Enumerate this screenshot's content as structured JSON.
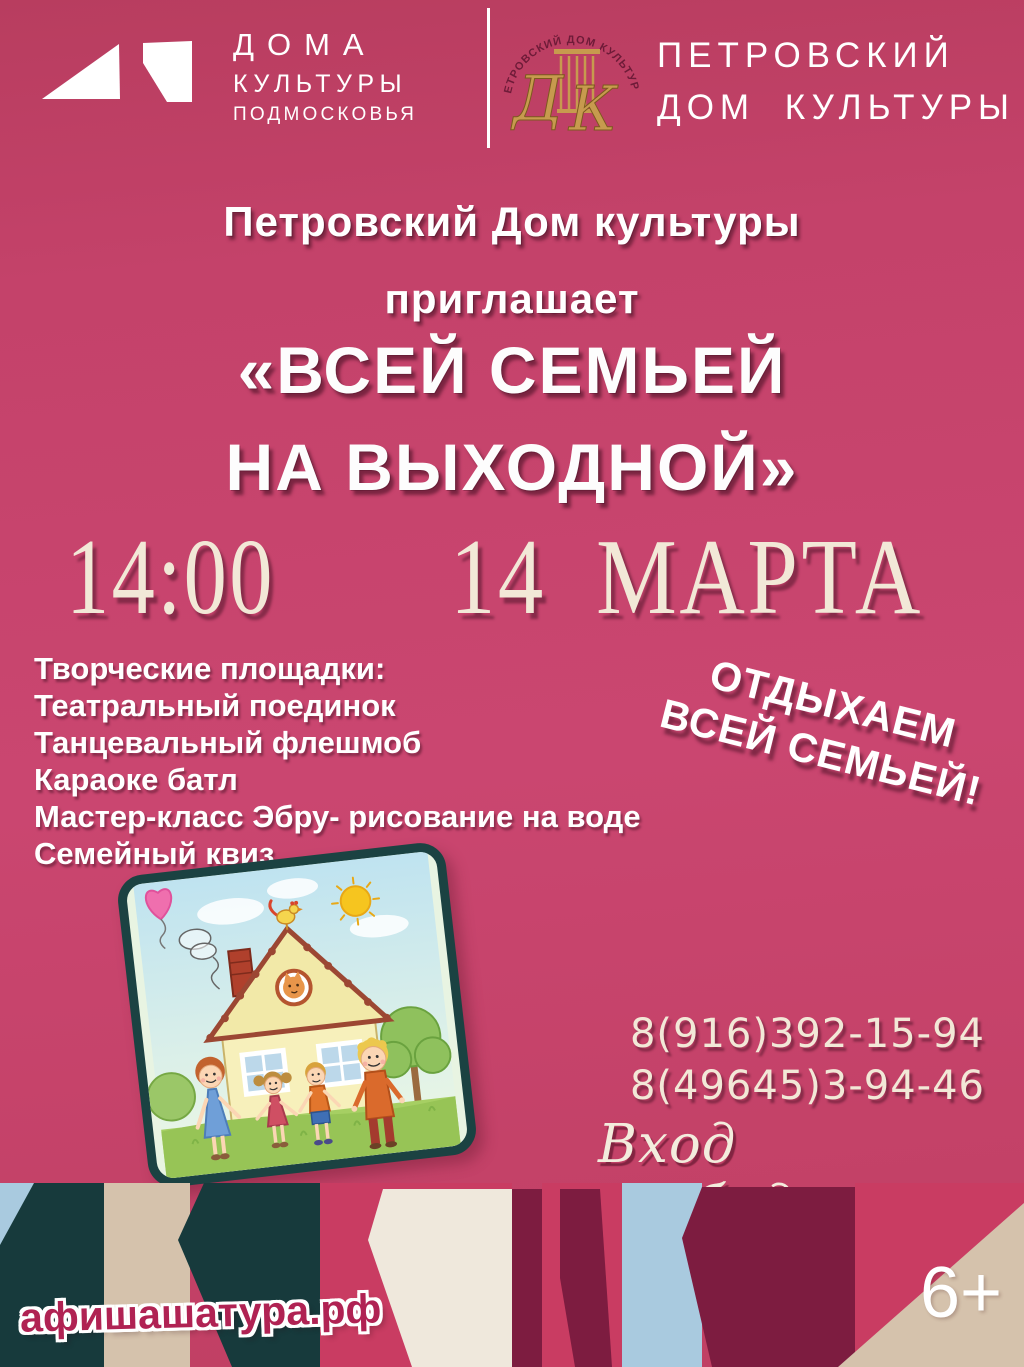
{
  "header": {
    "brand_left": {
      "line1": "ДОМА",
      "line2": "КУЛЬТУРЫ",
      "line3": "ПОДМОСКОВЬЯ"
    },
    "brand_right": {
      "line1": "ПЕТРОВСКИЙ",
      "line2": "ДОМ КУЛЬТУРЫ",
      "emblem_arc_text": "ПЕТРОВСКИЙ ДОМ КУЛЬТУРЫ",
      "monogram_d": "Д",
      "monogram_k": "К"
    }
  },
  "intro": {
    "line1": "Петровский Дом культуры",
    "line2": "приглашает"
  },
  "title": {
    "line1": "«ВСЕЙ СЕМЬЕЙ",
    "line2": "НА ВЫХОДНОЙ»"
  },
  "schedule": {
    "time": "14:00",
    "date": "14 МАРТА"
  },
  "activities": {
    "heading": "Творческие площадки:",
    "items": [
      "Театральный поединок",
      "Танцевальный флешмоб",
      "Караоке батл",
      "Мастер-класс Эбру- рисование на воде",
      "Семейный квиз"
    ]
  },
  "slogan": {
    "line1": "ОТДЫХАЕМ",
    "line2": "ВСЕЙ СЕМЬЕЙ!"
  },
  "contacts": {
    "phone1": "8(916)392-15-94",
    "phone2": "8(49645)3-94-46",
    "admission": "Вход свободный"
  },
  "footer": {
    "site": "афишашатура.рф",
    "age_rating": "6+"
  },
  "illustration": {
    "name": "cartoon-family-house"
  },
  "colors": {
    "background": "#c4426a",
    "text_cream": "#f2e8d7",
    "band_teal": "#173a3c",
    "band_blue": "#a9cadf",
    "band_beige": "#d5c2ac",
    "band_cream": "#efe8dc",
    "band_maroon": "#7d1c40",
    "band_crimson": "#c93c62",
    "emblem_gold": "#c79a4e",
    "site_text": "#b02253"
  }
}
